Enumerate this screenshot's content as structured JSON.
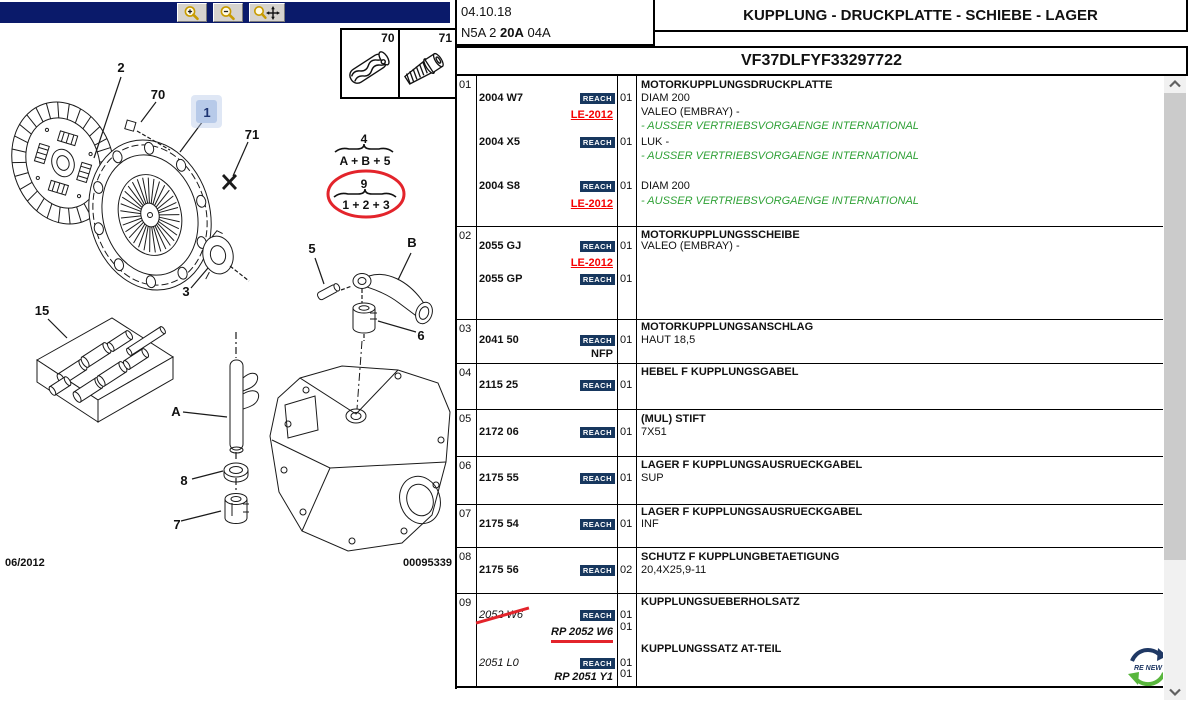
{
  "header": {
    "date": "04.10.18",
    "code_prefix": "N5A 2 ",
    "code_bold": "20A",
    "code_suffix": " 04A",
    "title": "KUPPLUNG - DRUCKPLATTE - SCHIEBE - LAGER",
    "vin": "VF37DLFYF33297722"
  },
  "toolbar": {
    "icons": [
      "magnifier-plus",
      "magnifier-minus",
      "magnifier-move"
    ]
  },
  "diagram": {
    "inset": [
      "70",
      "71"
    ],
    "callouts": {
      "n1": "1",
      "n2": "2",
      "n3": "3",
      "n5": "5",
      "n6": "6",
      "n7": "7",
      "n8": "8",
      "n15": "15",
      "n70": "70",
      "n71": "71",
      "nA": "A",
      "nB": "B"
    },
    "selected_callout": "1",
    "formula1": {
      "top": "4",
      "expr": "A + B + 5"
    },
    "formula2": {
      "top": "9",
      "expr": "1 + 2 + 3"
    },
    "footer_left": "06/2012",
    "footer_right": "00095339"
  },
  "badges": {
    "reach": "REACH"
  },
  "logo": {
    "text": "RE NEW"
  },
  "colors": {
    "toolbar_navy": "#0a1a6a",
    "reach_navy": "#17375e",
    "alert_red": "#f50000",
    "mark_red": "#e3242b",
    "info_green": "#2fa136",
    "selection_blue": "#b7cae9"
  },
  "table": {
    "rows": [
      {
        "ref": "01",
        "height": 151,
        "lines": [
          {
            "dy": 4,
            "desc": "MOTORKUPPLUNGSDRUCKPLATTE",
            "desc_style": "header"
          },
          {
            "dy": 17,
            "part": "2004 W7",
            "part_style": "bold",
            "reach": true,
            "qty": "01",
            "desc": "DIAM 200"
          },
          {
            "dy": 31,
            "desc": "VALEO (EMBRAY) -"
          },
          {
            "dy": 34,
            "part": "LE-2012",
            "part_style": "le"
          },
          {
            "dy": 45,
            "desc": "- AUSSER VERTRIEBSVORGAENGE INTERNATIONAL",
            "desc_style": "green"
          },
          {
            "dy": 61,
            "part": "2004 X5",
            "part_style": "bold",
            "reach": true,
            "qty": "01",
            "desc": "LUK -"
          },
          {
            "dy": 75,
            "desc": "- AUSSER VERTRIEBSVORGAENGE INTERNATIONAL",
            "desc_style": "green"
          },
          {
            "dy": 105,
            "part": "2004 S8",
            "part_style": "bold",
            "reach": true,
            "qty": "01",
            "desc": "DIAM 200"
          },
          {
            "dy": 120,
            "desc": "- AUSSER VERTRIEBSVORGAENGE INTERNATIONAL",
            "desc_style": "green"
          },
          {
            "dy": 123,
            "part": "LE-2012",
            "part_style": "le"
          }
        ]
      },
      {
        "ref": "02",
        "height": 93,
        "lines": [
          {
            "dy": 3,
            "desc": "MOTORKUPPLUNGSSCHEIBE",
            "desc_style": "header"
          },
          {
            "dy": 14,
            "part": "2055 GJ",
            "part_style": "bold",
            "reach": true,
            "qty": "01",
            "desc": "VALEO (EMBRAY) -"
          },
          {
            "dy": 31,
            "part": "LE-2012",
            "part_style": "le"
          },
          {
            "dy": 47,
            "part": "2055 GP",
            "part_style": "bold",
            "reach": true,
            "qty": "01"
          }
        ]
      },
      {
        "ref": "03",
        "height": 44,
        "lines": [
          {
            "dy": 2,
            "desc": "MOTORKUPPLUNGSANSCHLAG",
            "desc_style": "header"
          },
          {
            "dy": 15,
            "part": "2041 50",
            "part_style": "bold",
            "reach": true,
            "qty": "01",
            "desc": "HAUT 18,5"
          },
          {
            "dy": 29,
            "part": "NFP",
            "part_style": "nfp"
          }
        ]
      },
      {
        "ref": "04",
        "height": 46,
        "lines": [
          {
            "dy": 3,
            "desc": "HEBEL F KUPPLUNGSGABEL",
            "desc_style": "header"
          },
          {
            "dy": 16,
            "part": "2115 25",
            "part_style": "bold",
            "reach": true,
            "qty": "01"
          }
        ]
      },
      {
        "ref": "05",
        "height": 47,
        "lines": [
          {
            "dy": 4,
            "desc": "(MUL) STIFT",
            "desc_style": "header"
          },
          {
            "dy": 17,
            "part": "2172 06",
            "part_style": "bold",
            "reach": true,
            "qty": "01",
            "desc": "7X51"
          }
        ]
      },
      {
        "ref": "06",
        "height": 48,
        "lines": [
          {
            "dy": 3,
            "desc": "LAGER F KUPPLUNGSAUSRUECKGABEL",
            "desc_style": "header"
          },
          {
            "dy": 16,
            "part": "2175 55",
            "part_style": "bold",
            "reach": true,
            "qty": "01",
            "desc": "SUP"
          }
        ]
      },
      {
        "ref": "07",
        "height": 43,
        "lines": [
          {
            "dy": 2,
            "desc": "LAGER F KUPPLUNGSAUSRUECKGABEL",
            "desc_style": "header"
          },
          {
            "dy": 14,
            "part": "2175 54",
            "part_style": "bold",
            "reach": true,
            "qty": "01",
            "desc": "INF"
          }
        ]
      },
      {
        "ref": "08",
        "height": 46,
        "lines": [
          {
            "dy": 4,
            "desc": "SCHUTZ F KUPPLUNGBETAETIGUNG",
            "desc_style": "header"
          },
          {
            "dy": 17,
            "part": "2175 56",
            "part_style": "bold",
            "reach": true,
            "qty": "02",
            "desc": "20,4X25,9-11"
          }
        ]
      },
      {
        "ref": "09",
        "height": 95,
        "lines": [
          {
            "dy": 3,
            "desc": "KUPPLUNGSUEBERHOLSATZ",
            "desc_style": "header"
          },
          {
            "dy": 16,
            "part": "2052 W6",
            "part_style": "strike",
            "reach": true,
            "qty": "01"
          },
          {
            "dy": 28,
            "qty": "01"
          },
          {
            "dy": 33,
            "part": "RP 2052 W6",
            "part_style": "rp-underline"
          },
          {
            "dy": 50,
            "desc": "KUPPLUNGSSATZ AT-TEIL",
            "desc_style": "header"
          },
          {
            "dy": 64,
            "part": "2051 L0",
            "part_style": "italic",
            "reach": true,
            "qty": "01"
          },
          {
            "dy": 75,
            "qty": "01"
          },
          {
            "dy": 78,
            "part": "RP 2051 Y1",
            "part_style": "rp"
          }
        ]
      }
    ]
  }
}
